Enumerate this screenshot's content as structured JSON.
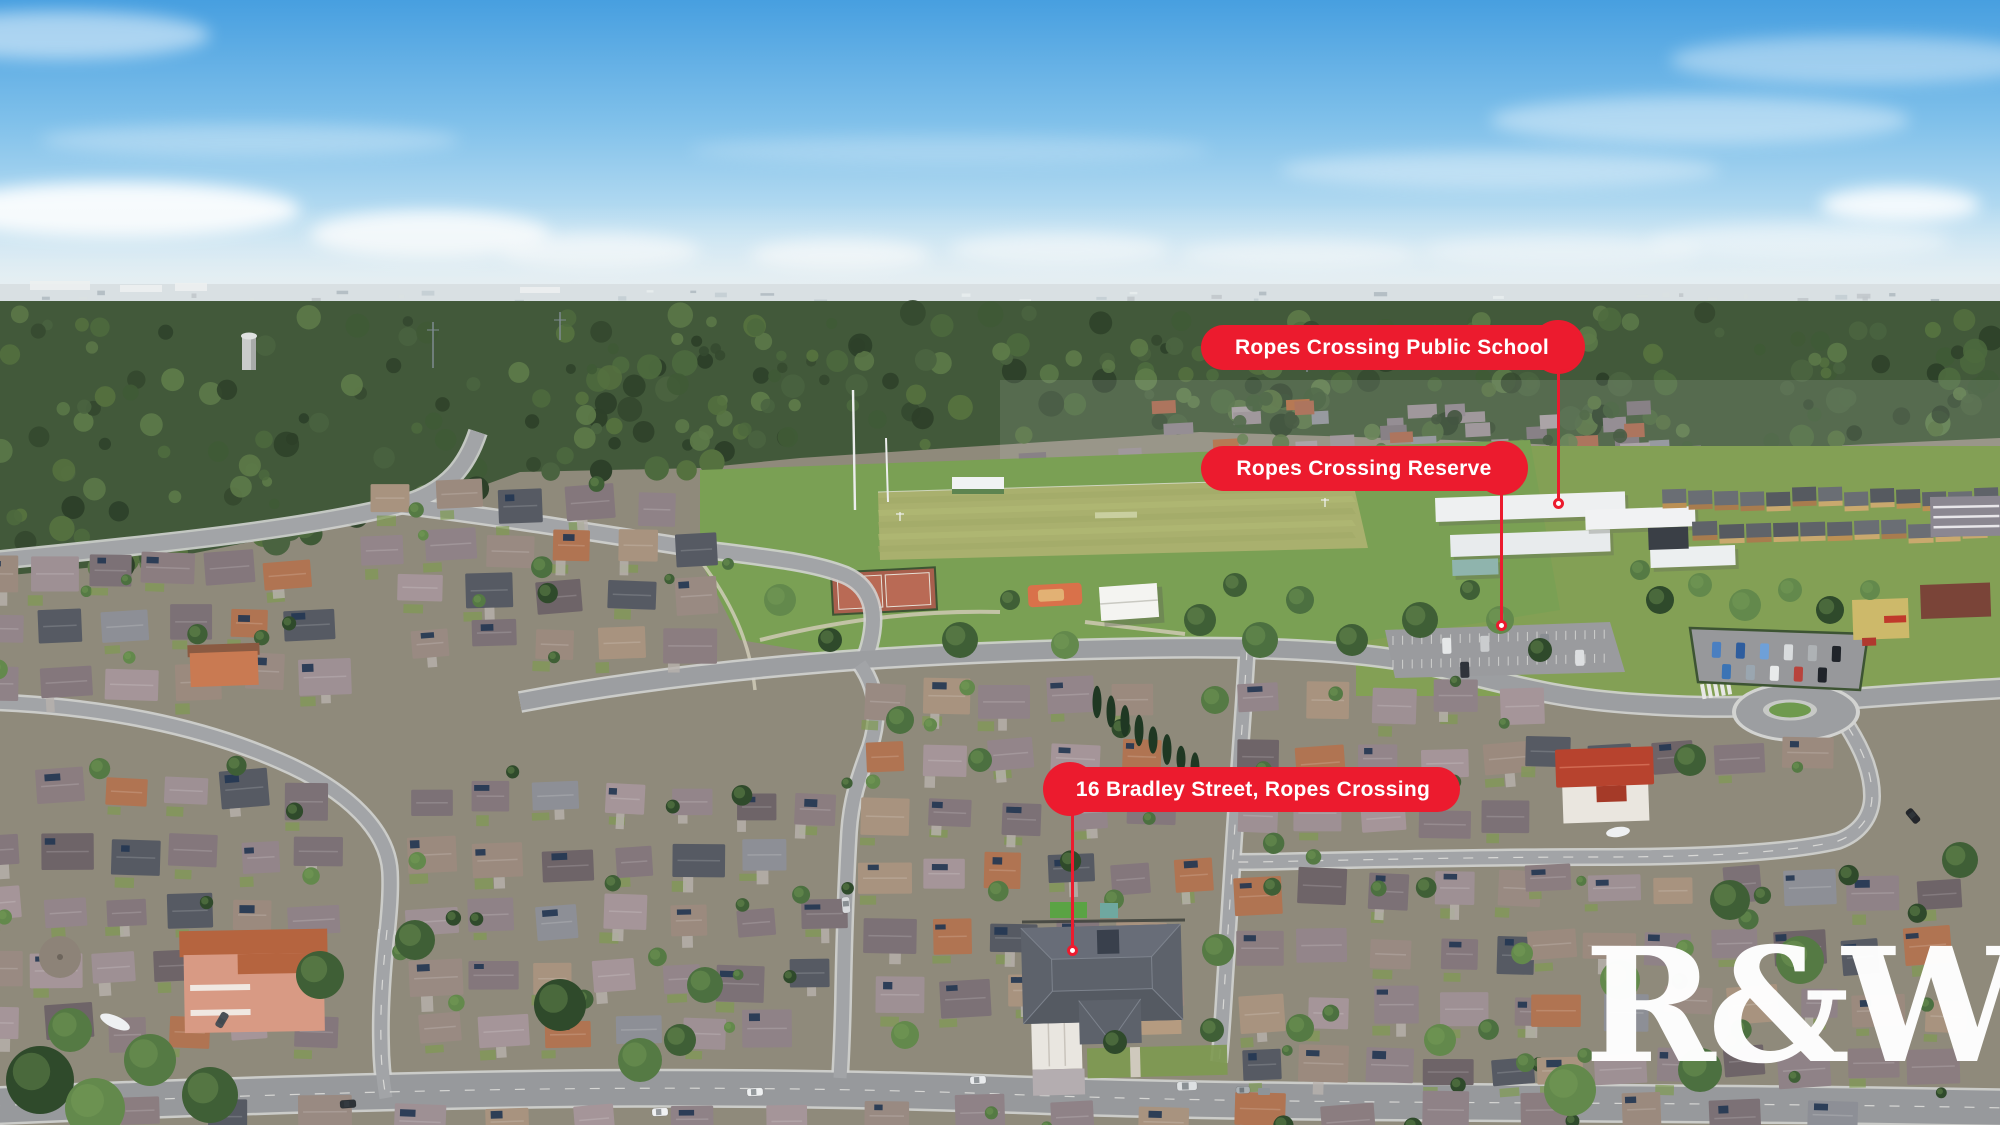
{
  "callouts": [
    {
      "label": "Ropes Crossing Public School"
    },
    {
      "label": "Ropes Crossing Reserve"
    },
    {
      "label": "16 Bradley Street, Ropes Crossing"
    }
  ],
  "watermark": {
    "text": "R&W"
  },
  "colors": {
    "brand_red": "#EC1B2E",
    "label_text": "#FFFFFF",
    "watermark_white": "#FFFFFF"
  }
}
